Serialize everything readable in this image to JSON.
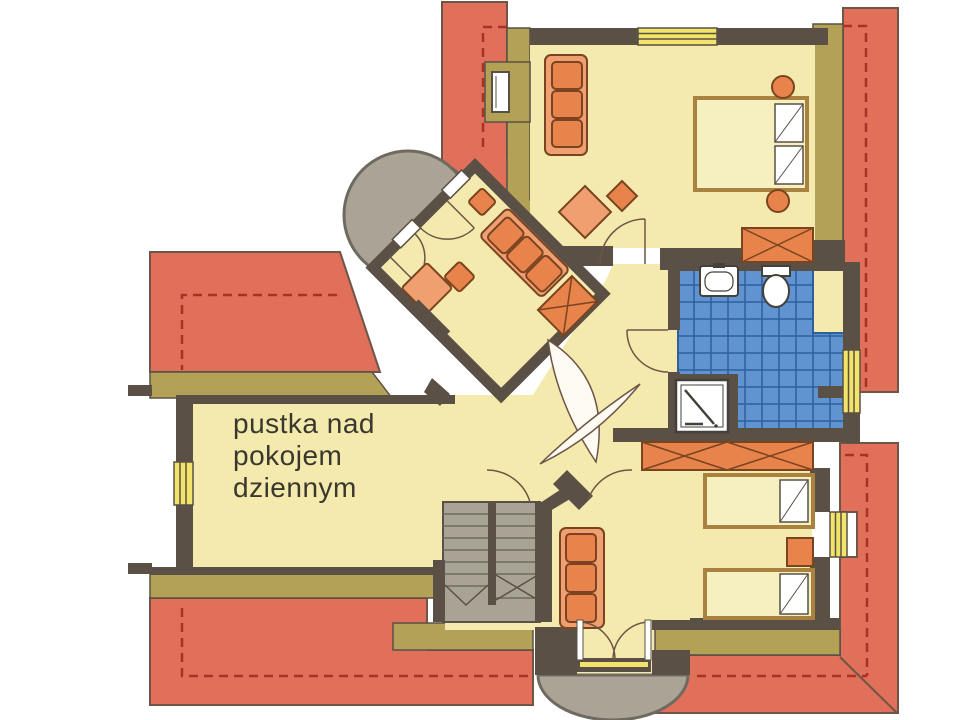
{
  "annotation": {
    "line1": "pustka nad",
    "line2": "pokojem",
    "line3": "dziennym"
  },
  "palette": {
    "background": "#ffffff",
    "roof": "#e0705a",
    "roof_dash": "#a93226",
    "roof_edge": "#6e5546",
    "knee_wall": "#b3a155",
    "floor": "#f4eaae",
    "wall": "#5a5046",
    "tile": "#5f94d0",
    "tile_grout": "#2f5f9e",
    "balcony": "#aba496",
    "stairs": "#a9a396",
    "window": "#f2e468",
    "roof_window": "#ffffff",
    "furniture": "#e8834c",
    "furniture_light": "#f0a070",
    "bed_frame": "#a9823f",
    "bed_fill": "#f6efc0",
    "fixture": "#ffffff",
    "door_leaf": "#fdfbf2",
    "text": "#3a382e"
  }
}
